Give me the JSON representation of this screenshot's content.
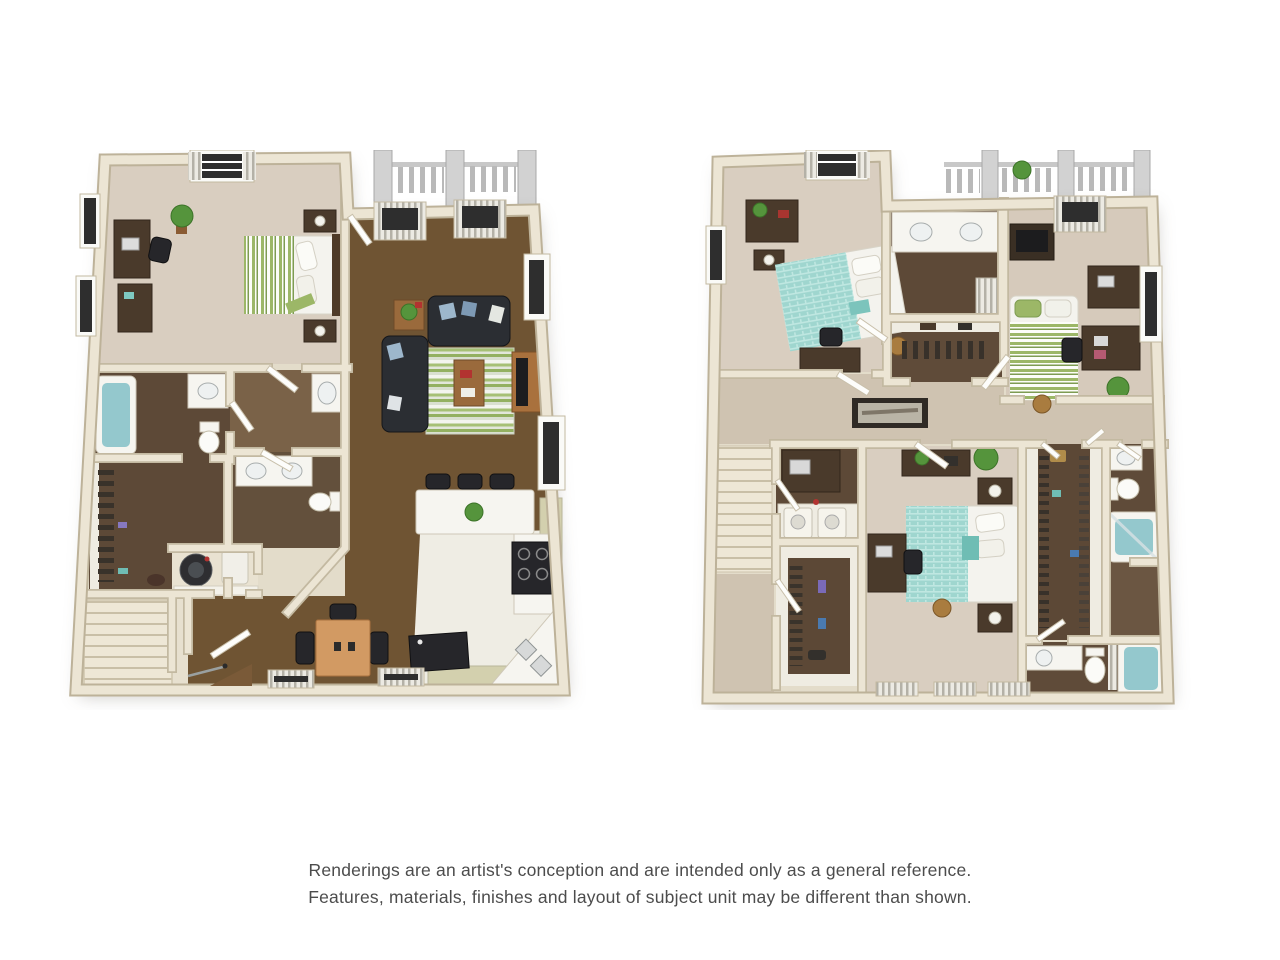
{
  "page": {
    "background_color": "#ffffff",
    "width": 1280,
    "height": 960
  },
  "disclaimer": {
    "line1": "Renderings are an artist's conception and are intended only as a general reference.",
    "line2": "Features, materials, finishes and layout of subject unit may be different than shown.",
    "text_color": "#4c4c4c"
  },
  "palette": {
    "wall": "#ece5d4",
    "wall_edge": "#c3b9a1",
    "carpet": "#d9cec0",
    "carpet_dark": "#cfc3b1",
    "brown_floor": "#6f5433",
    "wood_dark": "#5d4937",
    "wood_mid": "#7a6248",
    "counter_white": "#f6f5f0",
    "teal_water": "#94c8cd",
    "teal_bed": "#9fd6cf",
    "green_stripe": "#9cb767",
    "sofa_dark": "#2b2e33",
    "furniture_wood": "#4a3a2b",
    "table_light": "#d29a63",
    "cabinet_sage": "#d3d0ae",
    "appliance_black": "#26262a",
    "balcony_gray": "#d2d2d2",
    "rail_gray": "#b9b9b9",
    "plant_green": "#55943c",
    "window_dark": "#2e2e2e",
    "kitchen_floor": "#efede4",
    "vestibule_floor": "#e7e0cf"
  },
  "floorplans": {
    "left": {
      "name": "first-floor-plan",
      "rooms": [
        "bedroom",
        "living-room",
        "kitchen",
        "dining-area",
        "bathroom",
        "bathroom",
        "walk-in-closet",
        "laundry",
        "stairs",
        "entry",
        "balcony"
      ]
    },
    "right": {
      "name": "second-floor-plan",
      "rooms": [
        "bedroom",
        "bedroom",
        "bedroom",
        "bathroom",
        "bathroom",
        "bathroom",
        "walk-in-closet",
        "walk-in-closet",
        "laundry",
        "hallway",
        "stairs",
        "balcony"
      ]
    }
  }
}
